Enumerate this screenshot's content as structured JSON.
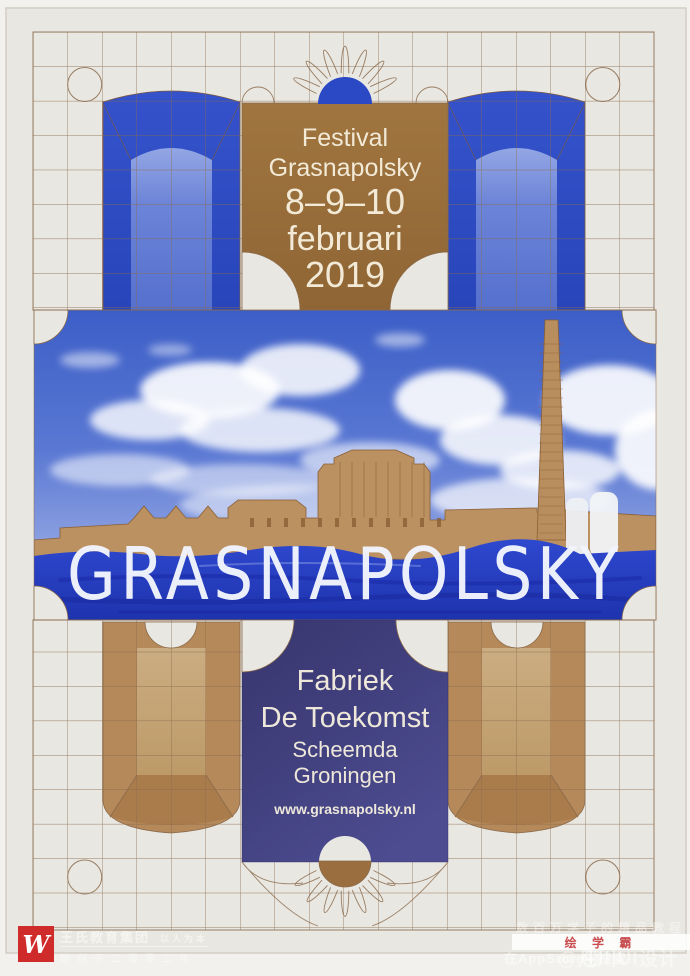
{
  "poster": {
    "header": {
      "festival": "Festival",
      "name": "Grasnapolsky",
      "dates": "8–9–10",
      "month": "februari",
      "year": "2019"
    },
    "main_title": "GRASNAPOLSKY",
    "venue": {
      "building_line1": "Fabriek",
      "building_line2": "De Toekomst",
      "town": "Scheemda",
      "province": "Groningen",
      "website": "www.grasnapolsky.nl"
    },
    "colors": {
      "paper": "#e9e7e1",
      "line_brown": "#8a6a4b",
      "block_brown": "#9a6e3e",
      "royal_blue": "#2b49c4",
      "indigo": "#41407e",
      "cream": "#f2ead7",
      "tan": "#b5895a"
    }
  },
  "watermarks": {
    "bottom_left": {
      "logo_letter": "W",
      "company": "王氏教育集团",
      "slogan": "以人为本",
      "founded": "始创于二零零二年",
      "logo_red": "#cf2b2b"
    },
    "bottom_right": {
      "tagline": "数百万学子的精品教程",
      "app_name": "绘 学 霸",
      "appstore_text": "在AppStore中搜索",
      "weibo_account": "@凡川UI设计"
    }
  }
}
